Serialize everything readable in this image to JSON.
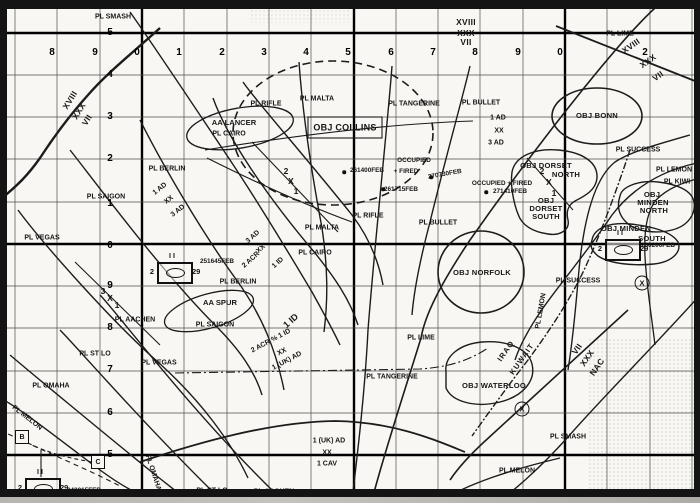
{
  "map": {
    "grid": {
      "easting_row_y": 53,
      "northing_col_x": 110,
      "easting_labels": [
        {
          "t": "8",
          "x": 52
        },
        {
          "t": "9",
          "x": 95
        },
        {
          "t": "0",
          "x": 137
        },
        {
          "t": "1",
          "x": 179
        },
        {
          "t": "2",
          "x": 222
        },
        {
          "t": "3",
          "x": 264
        },
        {
          "t": "4",
          "x": 306
        },
        {
          "t": "5",
          "x": 348
        },
        {
          "t": "6",
          "x": 391
        },
        {
          "t": "7",
          "x": 433
        },
        {
          "t": "8",
          "x": 475
        },
        {
          "t": "9",
          "x": 518
        },
        {
          "t": "0",
          "x": 560
        },
        {
          "t": "2",
          "x": 645
        }
      ],
      "northing_labels": [
        {
          "t": "5",
          "y": 33
        },
        {
          "t": "4",
          "y": 75
        },
        {
          "t": "3",
          "y": 117
        },
        {
          "t": "2",
          "y": 159
        },
        {
          "t": "1",
          "y": 204
        },
        {
          "t": "0",
          "y": 246
        },
        {
          "t": "9",
          "y": 286
        },
        {
          "t": "8",
          "y": 328
        },
        {
          "t": "7",
          "y": 370
        },
        {
          "t": "6",
          "y": 413
        },
        {
          "t": "5",
          "y": 455
        }
      ]
    },
    "labels": [
      {
        "t": "PL SMASH",
        "x": 113,
        "y": 17,
        "k": "pl"
      },
      {
        "t": "PL LIME",
        "x": 620,
        "y": 34,
        "k": "pl"
      },
      {
        "t": "PL RIFLE",
        "x": 266,
        "y": 104,
        "k": "pl"
      },
      {
        "t": "PL MALTA",
        "x": 317,
        "y": 99,
        "k": "pl"
      },
      {
        "t": "PL TANGERINE",
        "x": 414,
        "y": 104,
        "k": "pl"
      },
      {
        "t": "PL BULLET",
        "x": 481,
        "y": 103,
        "k": "pl"
      },
      {
        "t": "PL CAIRO",
        "x": 229,
        "y": 134,
        "k": "pl"
      },
      {
        "t": "PL BERLIN",
        "x": 167,
        "y": 169,
        "k": "pl"
      },
      {
        "t": "PL SAIGON",
        "x": 106,
        "y": 197,
        "k": "pl"
      },
      {
        "t": "PL VEGAS",
        "x": 42,
        "y": 238,
        "k": "pl"
      },
      {
        "t": "PL BERLIN",
        "x": 238,
        "y": 282,
        "k": "pl"
      },
      {
        "t": "PL SAIGON",
        "x": 215,
        "y": 325,
        "k": "pl"
      },
      {
        "t": "PL VEGAS",
        "x": 159,
        "y": 363,
        "k": "pl"
      },
      {
        "t": "PL ST LO",
        "x": 95,
        "y": 354,
        "k": "pl"
      },
      {
        "t": "PL OMAHA",
        "x": 51,
        "y": 386,
        "k": "pl"
      },
      {
        "t": "PL AACHEN",
        "x": 135,
        "y": 320,
        "k": "pl"
      },
      {
        "t": "PL MALTA",
        "x": 322,
        "y": 228,
        "k": "pl"
      },
      {
        "t": "PL RIFLE",
        "x": 368,
        "y": 216,
        "k": "pl"
      },
      {
        "t": "PL CAIRO",
        "x": 315,
        "y": 253,
        "k": "pl"
      },
      {
        "t": "PL BULLET",
        "x": 438,
        "y": 223,
        "k": "pl"
      },
      {
        "t": "PL TANGERINE",
        "x": 392,
        "y": 377,
        "k": "pl"
      },
      {
        "t": "PL LIME",
        "x": 421,
        "y": 338,
        "k": "pl"
      },
      {
        "t": "PL ST LO",
        "x": 212,
        "y": 491,
        "k": "pl"
      },
      {
        "t": "PL AACHEN",
        "x": 274,
        "y": 492,
        "k": "pl"
      },
      {
        "t": "PL MELON",
        "x": 27,
        "y": 418,
        "k": "pl",
        "r": 38
      },
      {
        "t": "PL OMAHA",
        "x": 153,
        "y": 473,
        "k": "pl",
        "r": 72
      },
      {
        "t": "PL MELON",
        "x": 517,
        "y": 471,
        "k": "pl"
      },
      {
        "t": "PL SMASH",
        "x": 568,
        "y": 437,
        "k": "pl"
      },
      {
        "t": "PL SUCCESS",
        "x": 638,
        "y": 150,
        "k": "pl"
      },
      {
        "t": "PL SUCCESS",
        "x": 578,
        "y": 281,
        "k": "pl"
      },
      {
        "t": "PL LEMON",
        "x": 674,
        "y": 170,
        "k": "pl"
      },
      {
        "t": "PL LEMON",
        "x": 541,
        "y": 311,
        "k": "pl",
        "r": -80
      },
      {
        "t": "PL KIWI",
        "x": 677,
        "y": 182,
        "k": "pl"
      },
      {
        "t": "OBJ COLLINS",
        "x": 345,
        "y": 128,
        "k": "obj",
        "s": 9
      },
      {
        "t": "OBJ BONN",
        "x": 597,
        "y": 116,
        "k": "obj"
      },
      {
        "t": "OBJ NORFOLK",
        "x": 482,
        "y": 273,
        "k": "obj"
      },
      {
        "t": "OBJ WATERLOO",
        "x": 494,
        "y": 386,
        "k": "obj"
      },
      {
        "t": "OBJ DORSET",
        "x": 546,
        "y": 166,
        "k": "obj"
      },
      {
        "t": "NORTH",
        "x": 566,
        "y": 175,
        "k": "obj"
      },
      {
        "t": "OBJ",
        "x": 546,
        "y": 201,
        "k": "obj"
      },
      {
        "t": "DORSET",
        "x": 546,
        "y": 209,
        "k": "obj"
      },
      {
        "t": "SOUTH",
        "x": 546,
        "y": 217,
        "k": "obj"
      },
      {
        "t": "OBJ",
        "x": 652,
        "y": 195,
        "k": "obj"
      },
      {
        "t": "MINDEN",
        "x": 653,
        "y": 203,
        "k": "obj"
      },
      {
        "t": "NORTH",
        "x": 654,
        "y": 211,
        "k": "obj"
      },
      {
        "t": "OBJ MINDEN",
        "x": 626,
        "y": 229,
        "k": "obj"
      },
      {
        "t": "SOUTH",
        "x": 652,
        "y": 239,
        "k": "obj"
      },
      {
        "t": "AA LANCER",
        "x": 234,
        "y": 123,
        "k": "aa"
      },
      {
        "t": "AA SPUR",
        "x": 220,
        "y": 303,
        "k": "aa"
      },
      {
        "t": "XVIII",
        "x": 466,
        "y": 22,
        "k": "corps"
      },
      {
        "t": "XXX",
        "x": 466,
        "y": 33,
        "k": "corps"
      },
      {
        "t": "VII",
        "x": 466,
        "y": 42,
        "k": "corps"
      },
      {
        "t": "XVIII",
        "x": 70,
        "y": 100,
        "k": "corps",
        "r": -58
      },
      {
        "t": "XXX",
        "x": 79,
        "y": 111,
        "k": "corps",
        "r": -58
      },
      {
        "t": "VII",
        "x": 87,
        "y": 120,
        "k": "corps",
        "r": -58
      },
      {
        "t": "XVIII",
        "x": 631,
        "y": 46,
        "k": "corps",
        "r": -35
      },
      {
        "t": "XXX",
        "x": 648,
        "y": 61,
        "k": "corps",
        "r": -35
      },
      {
        "t": "VII",
        "x": 658,
        "y": 76,
        "k": "corps",
        "r": -35
      },
      {
        "t": "VII",
        "x": 577,
        "y": 349,
        "k": "corps",
        "r": -55
      },
      {
        "t": "XXX",
        "x": 587,
        "y": 358,
        "k": "corps",
        "r": -55
      },
      {
        "t": "NAC",
        "x": 597,
        "y": 367,
        "k": "corps",
        "r": -55
      },
      {
        "t": "1 AD",
        "x": 160,
        "y": 189,
        "k": "unit",
        "r": -38
      },
      {
        "t": "XX",
        "x": 169,
        "y": 200,
        "k": "unit",
        "r": -38
      },
      {
        "t": "3 AD",
        "x": 178,
        "y": 211,
        "k": "unit",
        "r": -38
      },
      {
        "t": "1 AD",
        "x": 498,
        "y": 118,
        "k": "unit"
      },
      {
        "t": "XX",
        "x": 499,
        "y": 131,
        "k": "unit"
      },
      {
        "t": "3 AD",
        "x": 496,
        "y": 143,
        "k": "unit"
      },
      {
        "t": "3 AD",
        "x": 253,
        "y": 237,
        "k": "unit",
        "r": -42
      },
      {
        "t": "XX",
        "x": 261,
        "y": 249,
        "k": "unit",
        "r": -42
      },
      {
        "t": "2 ACR",
        "x": 251,
        "y": 260,
        "k": "unit",
        "r": -42
      },
      {
        "t": "1 ID",
        "x": 278,
        "y": 263,
        "k": "unit",
        "r": -42
      },
      {
        "t": "1 ID",
        "x": 291,
        "y": 321,
        "k": "unit",
        "r": -42,
        "s": 9
      },
      {
        "t": "2 ACR % 1 ID",
        "x": 271,
        "y": 341,
        "k": "unit",
        "r": -28
      },
      {
        "t": "XX",
        "x": 282,
        "y": 352,
        "k": "unit",
        "r": -28
      },
      {
        "t": "1 (UK) AD",
        "x": 287,
        "y": 361,
        "k": "unit",
        "r": -28
      },
      {
        "t": "1 (UK) AD",
        "x": 329,
        "y": 441,
        "k": "unit"
      },
      {
        "t": "XX",
        "x": 327,
        "y": 453,
        "k": "unit"
      },
      {
        "t": "1 CAV",
        "x": 327,
        "y": 464,
        "k": "unit"
      },
      {
        "t": "2",
        "x": 286,
        "y": 171,
        "k": "bdy"
      },
      {
        "t": "X",
        "x": 291,
        "y": 181,
        "k": "bdy"
      },
      {
        "t": "1",
        "x": 296,
        "y": 191,
        "k": "bdy"
      },
      {
        "t": "3",
        "x": 103,
        "y": 291,
        "k": "bdy"
      },
      {
        "t": "X",
        "x": 110,
        "y": 298,
        "k": "bdy"
      },
      {
        "t": "1",
        "x": 117,
        "y": 305,
        "k": "bdy"
      },
      {
        "t": "2",
        "x": 542,
        "y": 171,
        "k": "bdy"
      },
      {
        "t": "X",
        "x": 549,
        "y": 182,
        "k": "bdy"
      },
      {
        "t": "1",
        "x": 554,
        "y": 193,
        "k": "bdy"
      },
      {
        "t": "261400FEB",
        "x": 367,
        "y": 171,
        "k": "ann"
      },
      {
        "t": "OCCUPIED",
        "x": 414,
        "y": 161,
        "k": "ann"
      },
      {
        "t": "+ FIRED",
        "x": 406,
        "y": 172,
        "k": "ann"
      },
      {
        "t": "270730FEB",
        "x": 445,
        "y": 175,
        "k": "ann",
        "r": -10
      },
      {
        "t": "261715FEB",
        "x": 401,
        "y": 190,
        "k": "ann"
      },
      {
        "t": "OCCUPIED + FIRED",
        "x": 502,
        "y": 184,
        "k": "ann"
      },
      {
        "t": "271410FEB",
        "x": 510,
        "y": 192,
        "k": "ann"
      },
      {
        "t": "IRAQ",
        "x": 506,
        "y": 351,
        "k": "border",
        "r": -55
      },
      {
        "t": "KUWAIT",
        "x": 522,
        "y": 359,
        "k": "border",
        "r": -55
      }
    ],
    "unit_symbols": [
      {
        "x": 173,
        "y": 271,
        "left": "2",
        "right": "29",
        "echelon": "II",
        "timestamp": "251645FEB",
        "ts_x": 217,
        "ts_y": 262
      },
      {
        "x": 41,
        "y": 487,
        "left": "2",
        "right": "29",
        "echelon": "II",
        "timestamp": "242015FEB",
        "ts_x": 84,
        "ts_y": 491
      },
      {
        "x": 621,
        "y": 248,
        "left": "2",
        "right": "29",
        "echelon": "II",
        "timestamp": "280200FEB",
        "ts_x": 658,
        "ts_y": 246
      }
    ],
    "command_posts": [
      {
        "t": "B",
        "x": 22,
        "y": 437
      },
      {
        "t": "C",
        "x": 98,
        "y": 462
      }
    ],
    "checkpoints": [
      {
        "x": 642,
        "y": 283
      },
      {
        "x": 522,
        "y": 409
      }
    ],
    "event_dots": [
      {
        "x": 344,
        "y": 172
      },
      {
        "x": 383,
        "y": 189
      },
      {
        "x": 431,
        "y": 177
      },
      {
        "x": 486,
        "y": 192
      }
    ]
  }
}
